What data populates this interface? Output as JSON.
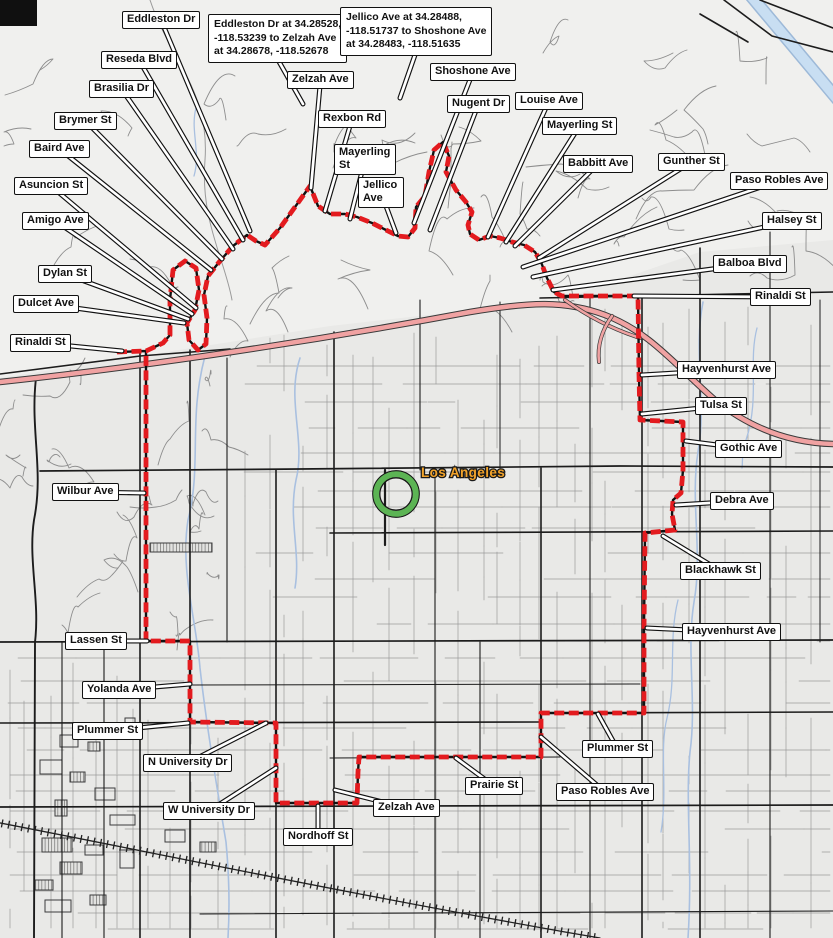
{
  "map": {
    "city_label": {
      "text": "Los Angeles",
      "color": "#f2a32a",
      "x": 421,
      "y": 477
    },
    "marker": {
      "x": 396,
      "y": 494,
      "ring_color": "#5cb454",
      "outline_color": "#151515"
    },
    "colors": {
      "background": "#e9e9e7",
      "hills": "#f0f0ee",
      "road_minor": "#9b9b9b",
      "road_mid": "#6f6f6f",
      "road_major": "#1c1c1c",
      "freeway_fill": "#f0a2a2",
      "freeway_casing": "#3a3a3a",
      "water": "#a9c0e0",
      "wash": "#c8def2",
      "route": "#e31b1f",
      "route_casing": "#111111",
      "railroad": "#222222"
    },
    "route": {
      "points": [
        [
          117,
          352
        ],
        [
          146,
          351
        ],
        [
          163,
          343
        ],
        [
          170,
          335
        ],
        [
          170,
          300
        ],
        [
          173,
          270
        ],
        [
          185,
          261
        ],
        [
          196,
          268
        ],
        [
          199,
          290
        ],
        [
          195,
          310
        ],
        [
          187,
          323
        ],
        [
          189,
          340
        ],
        [
          198,
          350
        ],
        [
          206,
          344
        ],
        [
          207,
          318
        ],
        [
          204,
          295
        ],
        [
          208,
          276
        ],
        [
          220,
          261
        ],
        [
          233,
          246
        ],
        [
          247,
          235
        ],
        [
          256,
          241
        ],
        [
          265,
          245
        ],
        [
          280,
          228
        ],
        [
          310,
          186
        ],
        [
          318,
          206
        ],
        [
          330,
          214
        ],
        [
          345,
          214
        ],
        [
          357,
          217
        ],
        [
          372,
          223
        ],
        [
          386,
          230
        ],
        [
          398,
          236
        ],
        [
          408,
          237
        ],
        [
          415,
          228
        ],
        [
          416,
          207
        ],
        [
          425,
          196
        ],
        [
          429,
          172
        ],
        [
          434,
          150
        ],
        [
          443,
          142
        ],
        [
          449,
          156
        ],
        [
          446,
          172
        ],
        [
          456,
          190
        ],
        [
          466,
          202
        ],
        [
          472,
          212
        ],
        [
          468,
          225
        ],
        [
          470,
          234
        ],
        [
          479,
          240
        ],
        [
          490,
          236
        ],
        [
          500,
          238
        ],
        [
          512,
          242
        ],
        [
          524,
          245
        ],
        [
          535,
          252
        ],
        [
          541,
          262
        ],
        [
          547,
          278
        ],
        [
          554,
          292
        ],
        [
          562,
          296
        ],
        [
          638,
          296
        ],
        [
          639,
          374
        ],
        [
          640,
          420
        ],
        [
          683,
          422
        ],
        [
          683,
          470
        ],
        [
          681,
          493
        ],
        [
          673,
          500
        ],
        [
          672,
          514
        ],
        [
          675,
          530
        ],
        [
          645,
          533
        ],
        [
          644,
          628
        ],
        [
          644,
          713
        ],
        [
          597,
          713
        ],
        [
          541,
          713
        ],
        [
          541,
          757
        ],
        [
          455,
          757
        ],
        [
          359,
          757
        ],
        [
          358,
          772
        ],
        [
          357,
          803
        ],
        [
          276,
          803
        ],
        [
          276,
          760
        ],
        [
          276,
          723
        ],
        [
          190,
          722
        ],
        [
          190,
          641
        ],
        [
          146,
          641
        ],
        [
          146,
          492
        ],
        [
          146,
          352
        ]
      ]
    },
    "labels": [
      {
        "id": "eddleston-dr",
        "text": "Eddleston Dr",
        "x": 122,
        "y": 11,
        "tx": 250,
        "ty": 231
      },
      {
        "id": "reseda-blvd",
        "text": "Reseda Blvd",
        "x": 101,
        "y": 51,
        "tx": 243,
        "ty": 240
      },
      {
        "id": "brasilia-dr",
        "text": "Brasilia Dr",
        "x": 89,
        "y": 80,
        "tx": 233,
        "ty": 249
      },
      {
        "id": "brymer-st",
        "text": "Brymer St",
        "x": 54,
        "y": 112,
        "tx": 222,
        "ty": 259
      },
      {
        "id": "baird-ave",
        "text": "Baird Ave",
        "x": 29,
        "y": 140,
        "tx": 211,
        "ty": 270
      },
      {
        "id": "asuncion-st",
        "text": "Asuncion St",
        "x": 14,
        "y": 177,
        "tx": 196,
        "ty": 308
      },
      {
        "id": "amigo-ave",
        "text": "Amigo Ave",
        "x": 22,
        "y": 212,
        "tx": 192,
        "ty": 314
      },
      {
        "id": "dylan-st",
        "text": "Dylan St",
        "x": 38,
        "y": 265,
        "tx": 188,
        "ty": 319
      },
      {
        "id": "dulcet-ave",
        "text": "Dulcet Ave",
        "x": 13,
        "y": 295,
        "tx": 184,
        "ty": 323
      },
      {
        "id": "rinaldi-st-west",
        "text": "Rinaldi St",
        "x": 10,
        "y": 334,
        "tx": 122,
        "ty": 351
      },
      {
        "id": "zelzah-ave-north",
        "text": "Zelzah Ave",
        "x": 287,
        "y": 71,
        "tx": 311,
        "ty": 188
      },
      {
        "id": "rexbon-rd",
        "text": "Rexbon Rd",
        "x": 318,
        "y": 110,
        "tx": 325,
        "ty": 211
      },
      {
        "id": "mayerling-st-west",
        "text": "Mayerling St",
        "x": 334,
        "y": 144,
        "w": 62,
        "tx": 350,
        "ty": 219
      },
      {
        "id": "jellico-ave",
        "text": "Jellico Ave",
        "x": 358,
        "y": 177,
        "w": 46,
        "tx": 396,
        "ty": 233
      },
      {
        "id": "shoshone-ave",
        "text": "Shoshone Ave",
        "x": 430,
        "y": 63,
        "tx": 414,
        "ty": 223
      },
      {
        "id": "nugent-dr",
        "text": "Nugent Dr",
        "x": 447,
        "y": 95,
        "tx": 430,
        "ty": 230
      },
      {
        "id": "louise-ave",
        "text": "Louise Ave",
        "x": 515,
        "y": 92,
        "tx": 488,
        "ty": 237
      },
      {
        "id": "mayerling-st-east",
        "text": "Mayerling St",
        "x": 542,
        "y": 117,
        "tx": 506,
        "ty": 242
      },
      {
        "id": "babbitt-ave",
        "text": "Babbitt Ave",
        "x": 563,
        "y": 155,
        "tx": 515,
        "ty": 246
      },
      {
        "id": "gunther-st",
        "text": "Gunther St",
        "x": 658,
        "y": 153,
        "tx": 539,
        "ty": 258
      },
      {
        "id": "paso-robles-ave-north",
        "text": "Paso Robles Ave",
        "x": 730,
        "y": 172,
        "tx": 523,
        "ty": 267
      },
      {
        "id": "halsey-st",
        "text": "Halsey St",
        "x": 762,
        "y": 212,
        "tx": 533,
        "ty": 277
      },
      {
        "id": "balboa-blvd",
        "text": "Balboa Blvd",
        "x": 713,
        "y": 255,
        "tx": 553,
        "ty": 290
      },
      {
        "id": "rinaldi-st-east",
        "text": "Rinaldi St",
        "x": 750,
        "y": 288,
        "tx": 634,
        "ty": 296
      },
      {
        "id": "hayvenhurst-ave-north",
        "text": "Hayvenhurst Ave",
        "x": 677,
        "y": 361,
        "tx": 642,
        "ty": 375
      },
      {
        "id": "tulsa-st",
        "text": "Tulsa St",
        "x": 695,
        "y": 397,
        "tx": 642,
        "ty": 414
      },
      {
        "id": "gothic-ave",
        "text": "Gothic Ave",
        "x": 715,
        "y": 440,
        "tx": 686,
        "ty": 441
      },
      {
        "id": "debra-ave",
        "text": "Debra Ave",
        "x": 710,
        "y": 492,
        "tx": 676,
        "ty": 505
      },
      {
        "id": "blackhawk-st",
        "text": "Blackhawk St",
        "x": 680,
        "y": 562,
        "tx": 663,
        "ty": 536
      },
      {
        "id": "hayvenhurst-ave-south",
        "text": "Hayvenhurst Ave",
        "x": 682,
        "y": 623,
        "tx": 647,
        "ty": 628
      },
      {
        "id": "plummer-st-east",
        "text": "Plummer St",
        "x": 582,
        "y": 740,
        "tx": 598,
        "ty": 714
      },
      {
        "id": "paso-robles-ave-south",
        "text": "Paso Robles Ave",
        "x": 556,
        "y": 783,
        "tx": 541,
        "ty": 737
      },
      {
        "id": "prairie-st",
        "text": "Prairie St",
        "x": 465,
        "y": 777,
        "tx": 456,
        "ty": 758
      },
      {
        "id": "zelzah-ave-south",
        "text": "Zelzah Ave",
        "x": 373,
        "y": 799,
        "tx": 335,
        "ty": 790
      },
      {
        "id": "nordhoff-st",
        "text": "Nordhoff St",
        "x": 283,
        "y": 828,
        "tx": 318,
        "ty": 806
      },
      {
        "id": "wilbur-ave",
        "text": "Wilbur Ave",
        "x": 52,
        "y": 483,
        "tx": 144,
        "ty": 493
      },
      {
        "id": "lassen-st",
        "text": "Lassen St",
        "x": 65,
        "y": 632,
        "tx": 147,
        "ty": 641
      },
      {
        "id": "yolanda-ave",
        "text": "Yolanda Ave",
        "x": 82,
        "y": 681,
        "tx": 190,
        "ty": 684
      },
      {
        "id": "plummer-st-west",
        "text": "Plummer St",
        "x": 72,
        "y": 722,
        "tx": 188,
        "ty": 723
      },
      {
        "id": "n-university-dr",
        "text": "N University Dr",
        "x": 143,
        "y": 754,
        "tx": 266,
        "ty": 723
      },
      {
        "id": "w-university-dr",
        "text": "W University Dr",
        "x": 163,
        "y": 802,
        "tx": 276,
        "ty": 768
      }
    ],
    "callouts": [
      {
        "id": "segment-callout-eddleston",
        "lines": [
          "Eddleston Dr at 34.28528,",
          "-118.53239 to Zelzah Ave",
          "at 34.28678, -118.52678"
        ],
        "x": 208,
        "y": 14,
        "tx": 303,
        "ty": 104
      },
      {
        "id": "segment-callout-jellico",
        "lines": [
          "Jellico Ave at 34.28488,",
          "-118.51737 to Shoshone Ave",
          "at 34.28483, -118.51635"
        ],
        "x": 340,
        "y": 7,
        "tx": 400,
        "ty": 98
      }
    ]
  }
}
